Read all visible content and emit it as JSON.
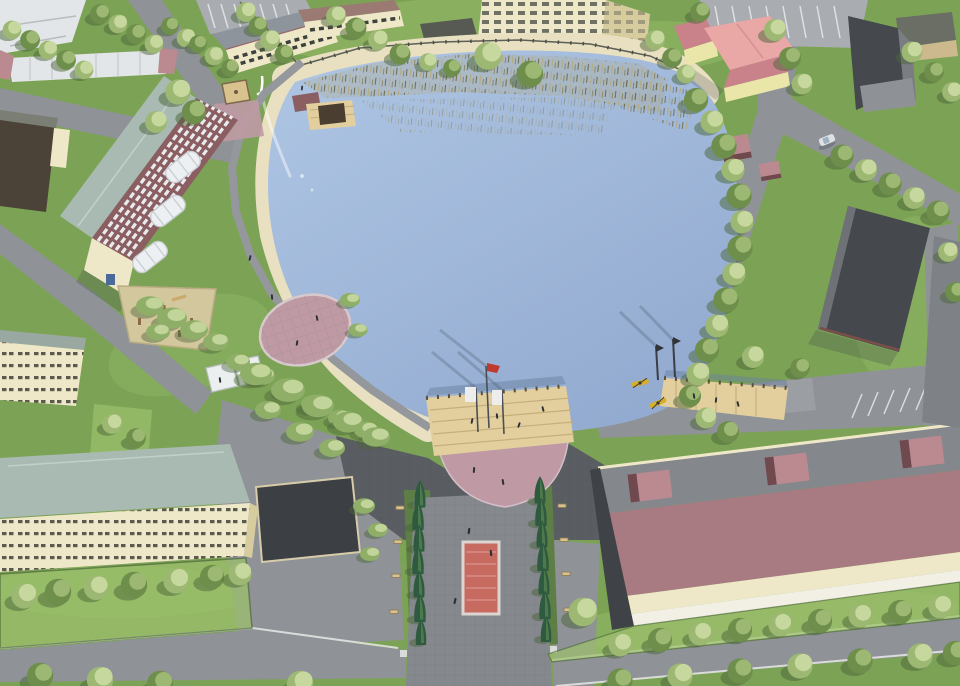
{
  "meta": {
    "title": "Aerial 3D rendering of a pond park redevelopment",
    "type": "architectural-visualization"
  },
  "colors": {
    "waterLight": "#afc6e4",
    "waterDeep": "#93abd0",
    "reedDark": "#6f7055",
    "reedTan": "#b4aa80",
    "sand": "#e9e0c2",
    "grass": "#7ca355",
    "grassLight": "#9cc06c",
    "treeLight": "#c6d89e",
    "treeMid": "#9db873",
    "treeDark": "#6e8e4b",
    "treeShadow": "#4c6639",
    "conifer": "#2e5a40",
    "coniferHl": "#55814f",
    "bush": "#8fae68",
    "road": "#8f9296",
    "roadLight": "#a9acb0",
    "plazaDark": "#595c60",
    "paver": "#85888d",
    "paverLine": "#6e7176",
    "pinkPaver": "#bf9aa4",
    "pinkPaverLight": "#d9c7cb",
    "deckWood": "#e3cf9e",
    "deckLine": "#c4ae7c",
    "post": "#5d4f38",
    "brick": "#8b5e62",
    "windowStripe": "#e9ecee",
    "roofSage": "#a9bab3",
    "cream": "#efe8c8",
    "creamShade": "#d6cc9e",
    "windowDark": "#3e423c",
    "mauve": "#a87a81",
    "flatRoof": "#84888d",
    "pinkBox": "#bb8a90",
    "pinkBoxDark": "#70494f",
    "darkWall": "#45484d",
    "darkWallHl": "#6e7277",
    "annexDark": "#3c3f43",
    "pinkRoof": "#e9a7a5",
    "pinkRoofDk": "#c9818a",
    "yellowWall": "#eae6a9",
    "schoolRoof": "#8e949b",
    "schoolTrim": "#96686a",
    "whiteBldg": "#e3e6e8",
    "flagRed": "#c0392f",
    "flagWhite": "#ededed",
    "kayak": "#d7ae28",
    "carpet": "#c76b60",
    "carpetRim": "#dcd6d2",
    "fence": "#5c5f55",
    "people": "#2c3036",
    "carWhite": "#dde1e4",
    "pathGray": "#94979b",
    "playSand": "#d3c79d",
    "playWood": "#8a6b46",
    "tanRoof": "#d9c28e"
  },
  "scene": {
    "features": [
      "pond",
      "sandy-beach",
      "reed-beds",
      "fountain",
      "boat-pier",
      "gazebo",
      "playground",
      "circular-plaza",
      "lakeside-promenade",
      "flag-deck",
      "kayak-pier",
      "sun-canopies",
      "red-apartment-building",
      "school-building",
      "high-rise-block",
      "pink-roof-cottage",
      "warehouses",
      "sports-hall",
      "residential-blocks",
      "storage-garages",
      "conifer-alley",
      "red-carpet-walkway",
      "roads",
      "parking-lots",
      "tree-rows",
      "benches",
      "people"
    ],
    "counts": {
      "red_flags": 1,
      "white_flags": 2,
      "kayaks": 2,
      "cars": 1,
      "sun_canopies": 3,
      "piers": 2
    },
    "palette_note": "midday sun from upper right, shadows fall lower-left"
  }
}
